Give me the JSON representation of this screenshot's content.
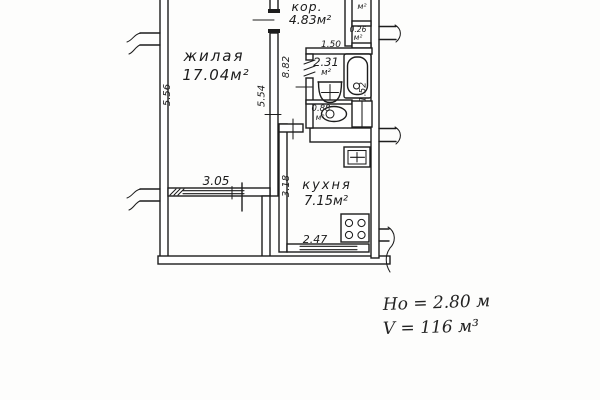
{
  "plan": {
    "rooms": {
      "living": {
        "name": "жилая",
        "area": "17.04м²"
      },
      "corridor": {
        "name": "кор.",
        "area": "4.83м²"
      },
      "kitchen": {
        "name": "кухня",
        "area": "7.15м²"
      },
      "bath": {
        "area": "2.31",
        "unit": "м²"
      },
      "wc": {
        "area": "0.88",
        "unit": "м²"
      },
      "closet": {
        "unit": "м²"
      },
      "pantry": {
        "area": "0.26",
        "unit": "м²"
      }
    },
    "dims": {
      "left_wall": "5.56",
      "living_wall": "5.54",
      "hall": "8.82",
      "window": "3.05",
      "bath_w": "1.50",
      "bath_d": "1.52",
      "kitchen_d": "3.18",
      "kitchen_w": "2.47"
    },
    "notes": {
      "ceiling": "Hо = 2.80 м",
      "volume": "V = 116 м³"
    },
    "colors": {
      "ink": "#1d1d1d",
      "paper": "#fdfdfc"
    }
  }
}
